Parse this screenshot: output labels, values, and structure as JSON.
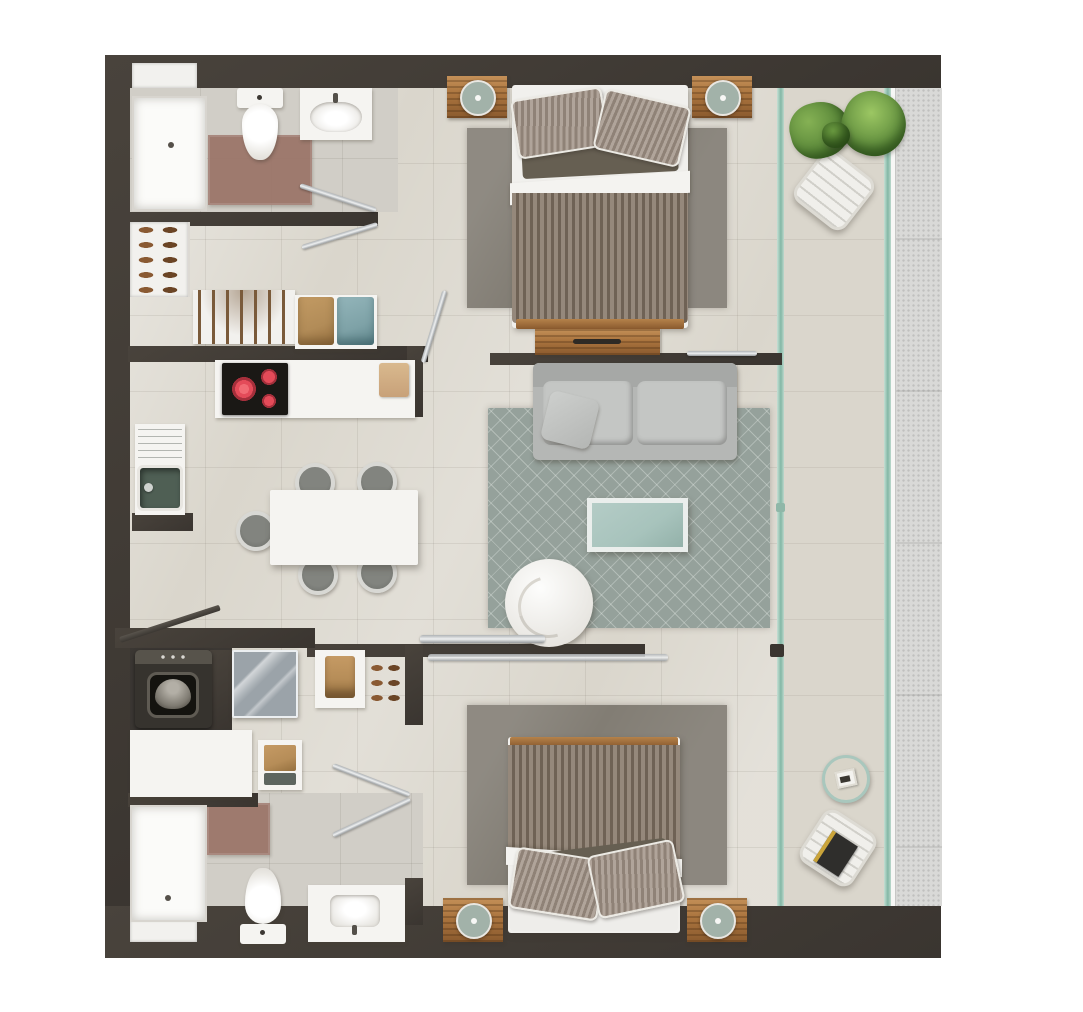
{
  "meta": {
    "title": "Two-bedroom apartment floor plan",
    "view": "top-down 3D render, no text labels"
  },
  "palette": {
    "wall": "#49433c",
    "walldark": "#3a3530",
    "floor": "#dad6cc",
    "bathfloor": "#d1cec7",
    "white": "#f5f4f1",
    "niche": "#f2f1ee",
    "wood": "#aa743e",
    "woodlight": "#c49058",
    "board": "#c8a179",
    "lamp": "#a2b2a9",
    "blanketa": "#95887b",
    "blanketb": "#6f6255",
    "pillowa": "#b0a49a",
    "pillowb": "#8f8277",
    "olive": "#665f52",
    "bedrug": "#827d74",
    "sofa": "#b5b7b5",
    "sofacushion": "#c4c6c4",
    "livingrug": "#95a19b",
    "coffee": "#a7c3bc",
    "chairgray": "#82847f",
    "chairring": "#d8d8d4",
    "cooktop": "#1a1815",
    "burner": "#e44b59",
    "sinkbasin": "#4f5f54",
    "mat": "#9b7468",
    "washer": "#36332e",
    "washerpanel": "#57534b",
    "dishwasher": "#9ba3a9",
    "boxtan": "#b28c58",
    "boxteal": "#7ea2a7",
    "glass": "#a9cfc0",
    "glassdeep": "#83b7a5",
    "strip": "#d9d9d7",
    "plantlight": "#85b154",
    "plantdark": "#4b7930",
    "chrome": "#c9ccce",
    "shoe": "#8a5a33",
    "shoedark": "#6b4526",
    "towel": "#b68d58"
  },
  "rooms": [
    "bathroom-1",
    "entry-closet",
    "kitchen",
    "dining-area",
    "living-room",
    "bedroom-1",
    "bedroom-2",
    "laundry-closet",
    "bathroom-2",
    "balcony"
  ],
  "furniture": {
    "bathroom1": [
      "shower",
      "toilet",
      "sink",
      "bath-mat",
      "wall-niche"
    ],
    "entry_closet": [
      "shoe-rack",
      "hanger-rail",
      "storage-boxes"
    ],
    "kitchen": [
      "induction-cooktop",
      "counter",
      "cutting-board",
      "sink-with-drainboard"
    ],
    "dining": [
      "table",
      "five-chairs"
    ],
    "living": [
      "sofa",
      "area-rug",
      "coffee-table",
      "swivel-armchair"
    ],
    "bedroom1": [
      "double-bed",
      "two-nightstands",
      "two-lamps",
      "rug",
      "dresser"
    ],
    "bedroom2": [
      "double-bed",
      "two-nightstands",
      "two-lamps",
      "rug",
      "sliding-door"
    ],
    "laundry": [
      "washing-machine",
      "dishwasher",
      "closet-shelf",
      "counter",
      "stool"
    ],
    "bathroom2": [
      "shower",
      "toilet",
      "vanity-sink",
      "bath-mat",
      "wall-niche"
    ],
    "balcony": [
      "potted-plant",
      "lounge-chair-top",
      "side-table",
      "lounge-chair-bottom",
      "glass-railing"
    ]
  }
}
